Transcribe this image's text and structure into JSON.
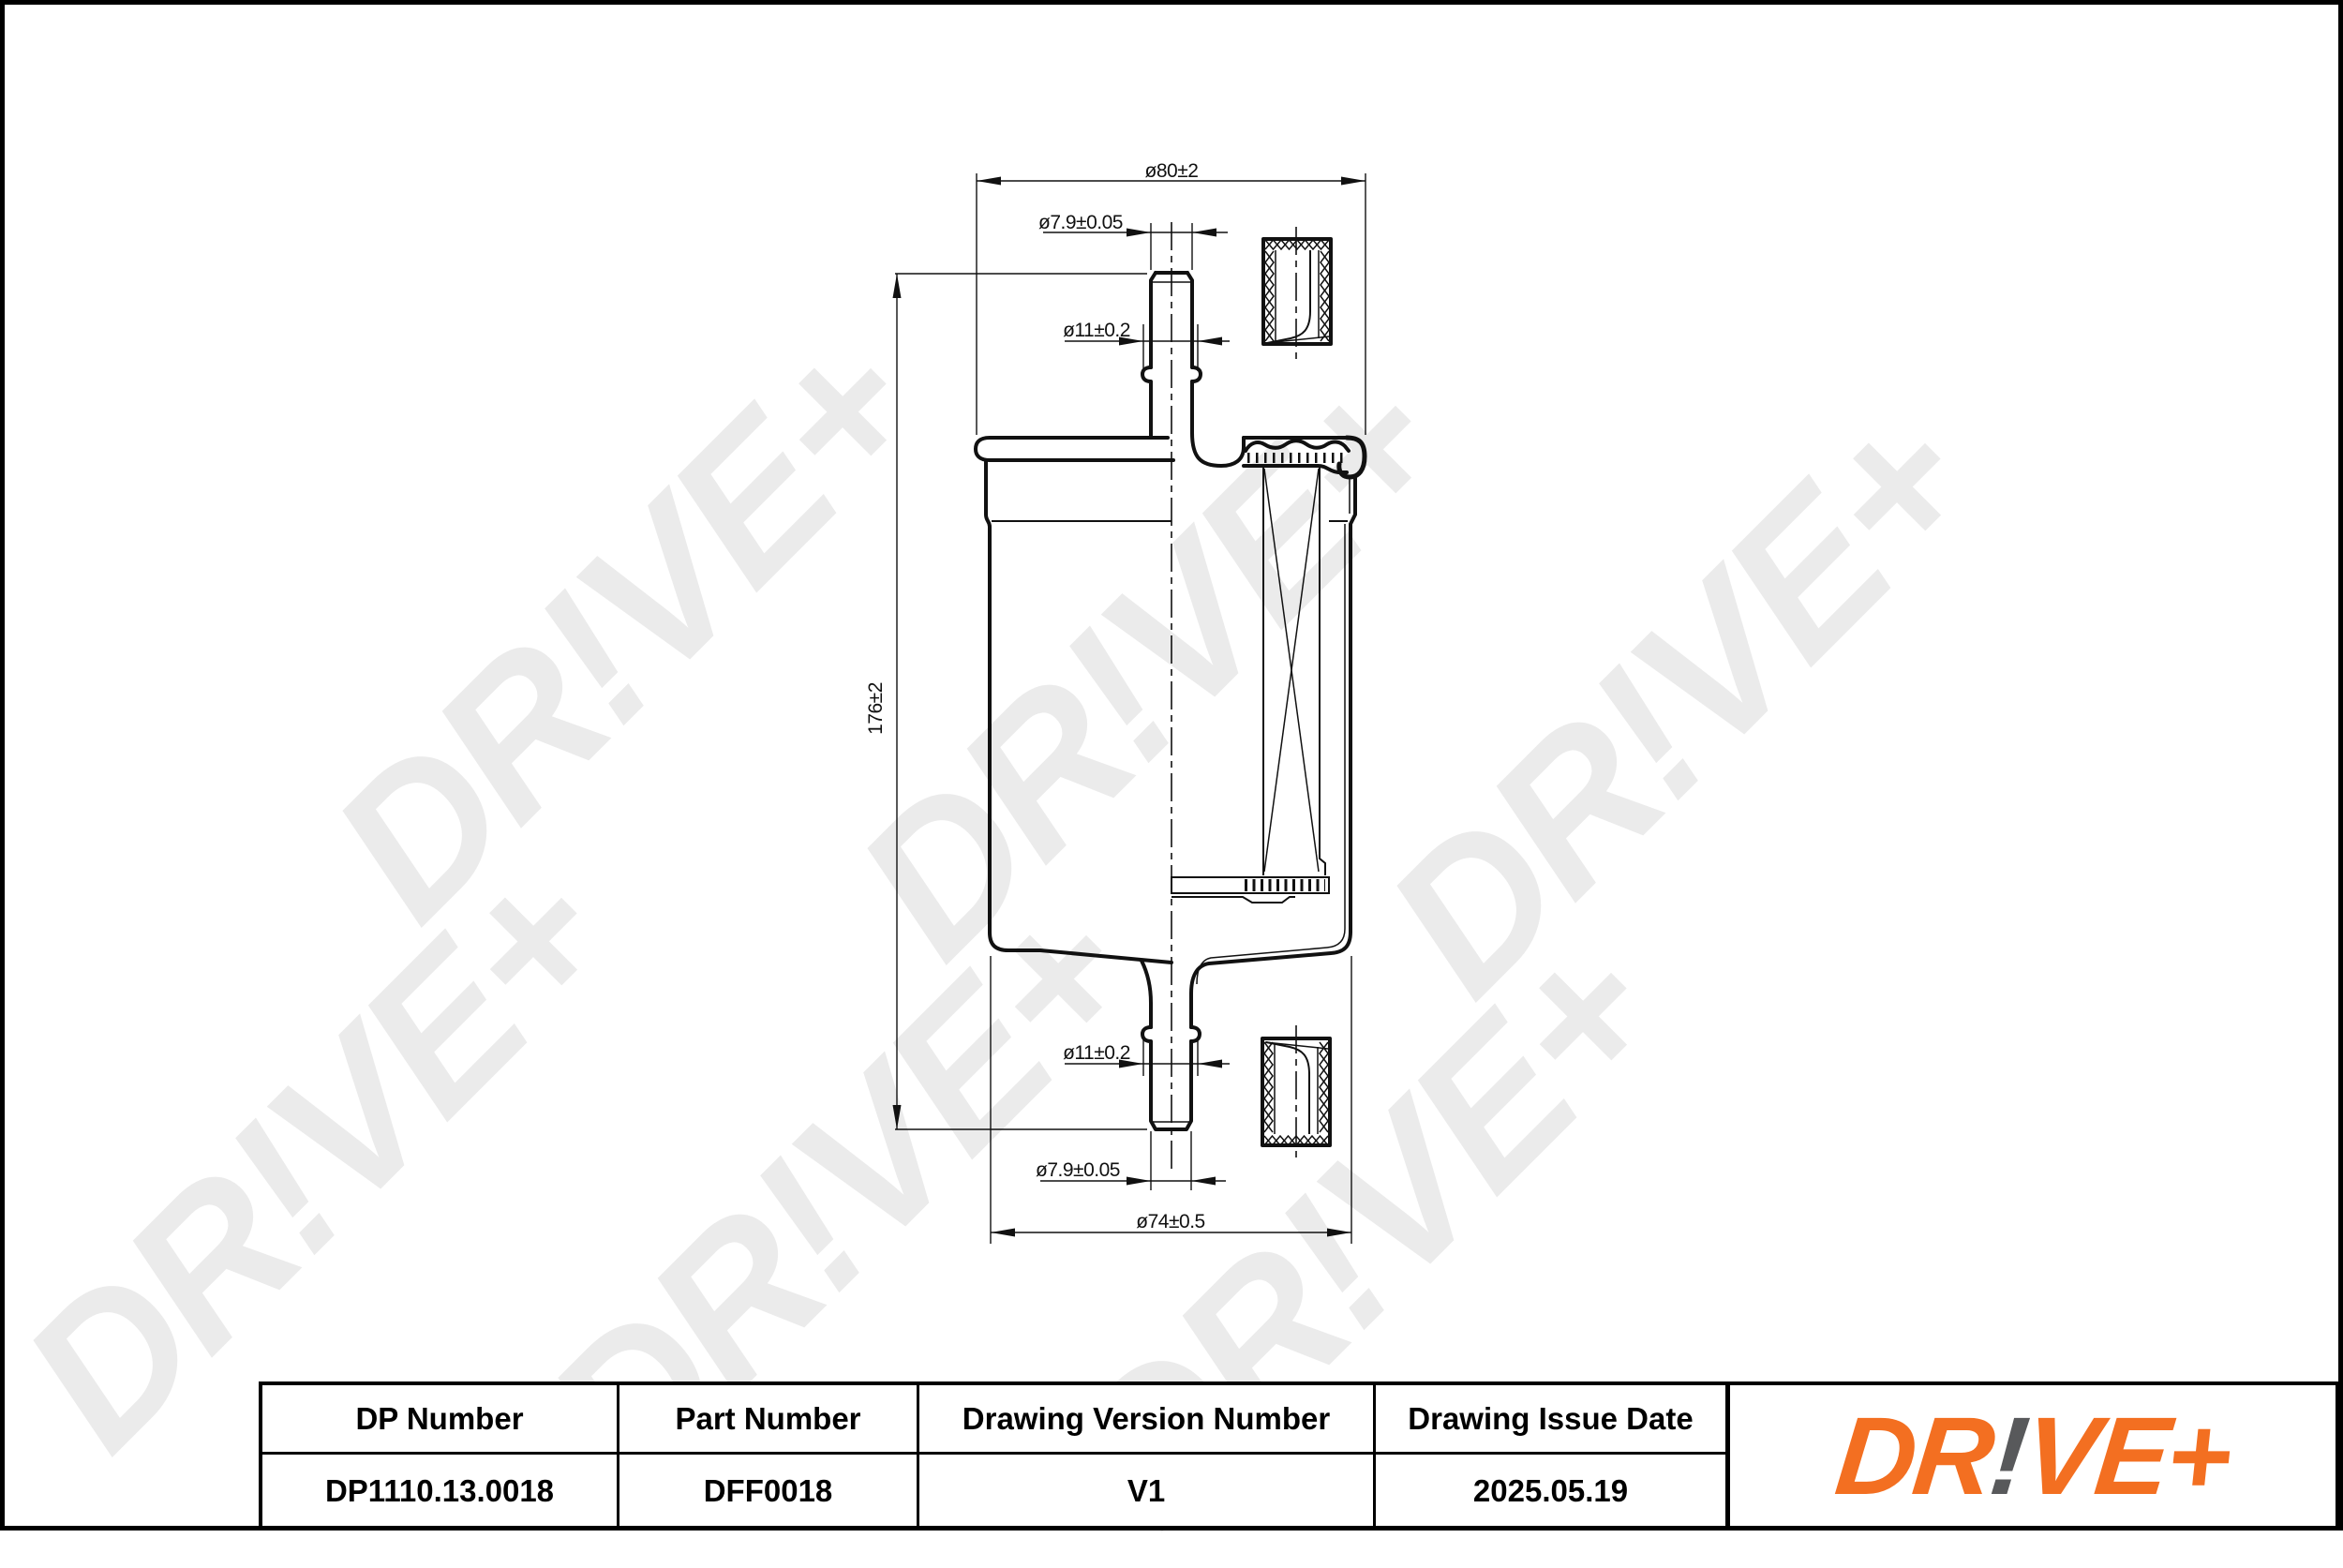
{
  "watermark": {
    "text": "DR!VE+",
    "color": "#ebebeb"
  },
  "drawing": {
    "dims": {
      "top_flange_diameter": "ø80±2",
      "top_port_diameter": "ø7.9±0.05",
      "top_bead_diameter": "ø11±0.2",
      "overall_length": "176±2",
      "bottom_bead_diameter": "ø11±0.2",
      "bottom_port_diameter": "ø7.9±0.05",
      "body_diameter": "ø74±0.5"
    }
  },
  "title_block": {
    "columns": [
      {
        "header": "DP Number",
        "value": "DP1110.13.0018"
      },
      {
        "header": "Part Number",
        "value": "DFF0018"
      },
      {
        "header": "Drawing Version Number",
        "value": "V1"
      },
      {
        "header": "Drawing Issue Date",
        "value": "2025.05.19"
      }
    ]
  },
  "logo": {
    "prefix": "DR",
    "bang": "!",
    "suffix": "VE+",
    "orange": "#F36F21",
    "gray": "#58595B"
  }
}
